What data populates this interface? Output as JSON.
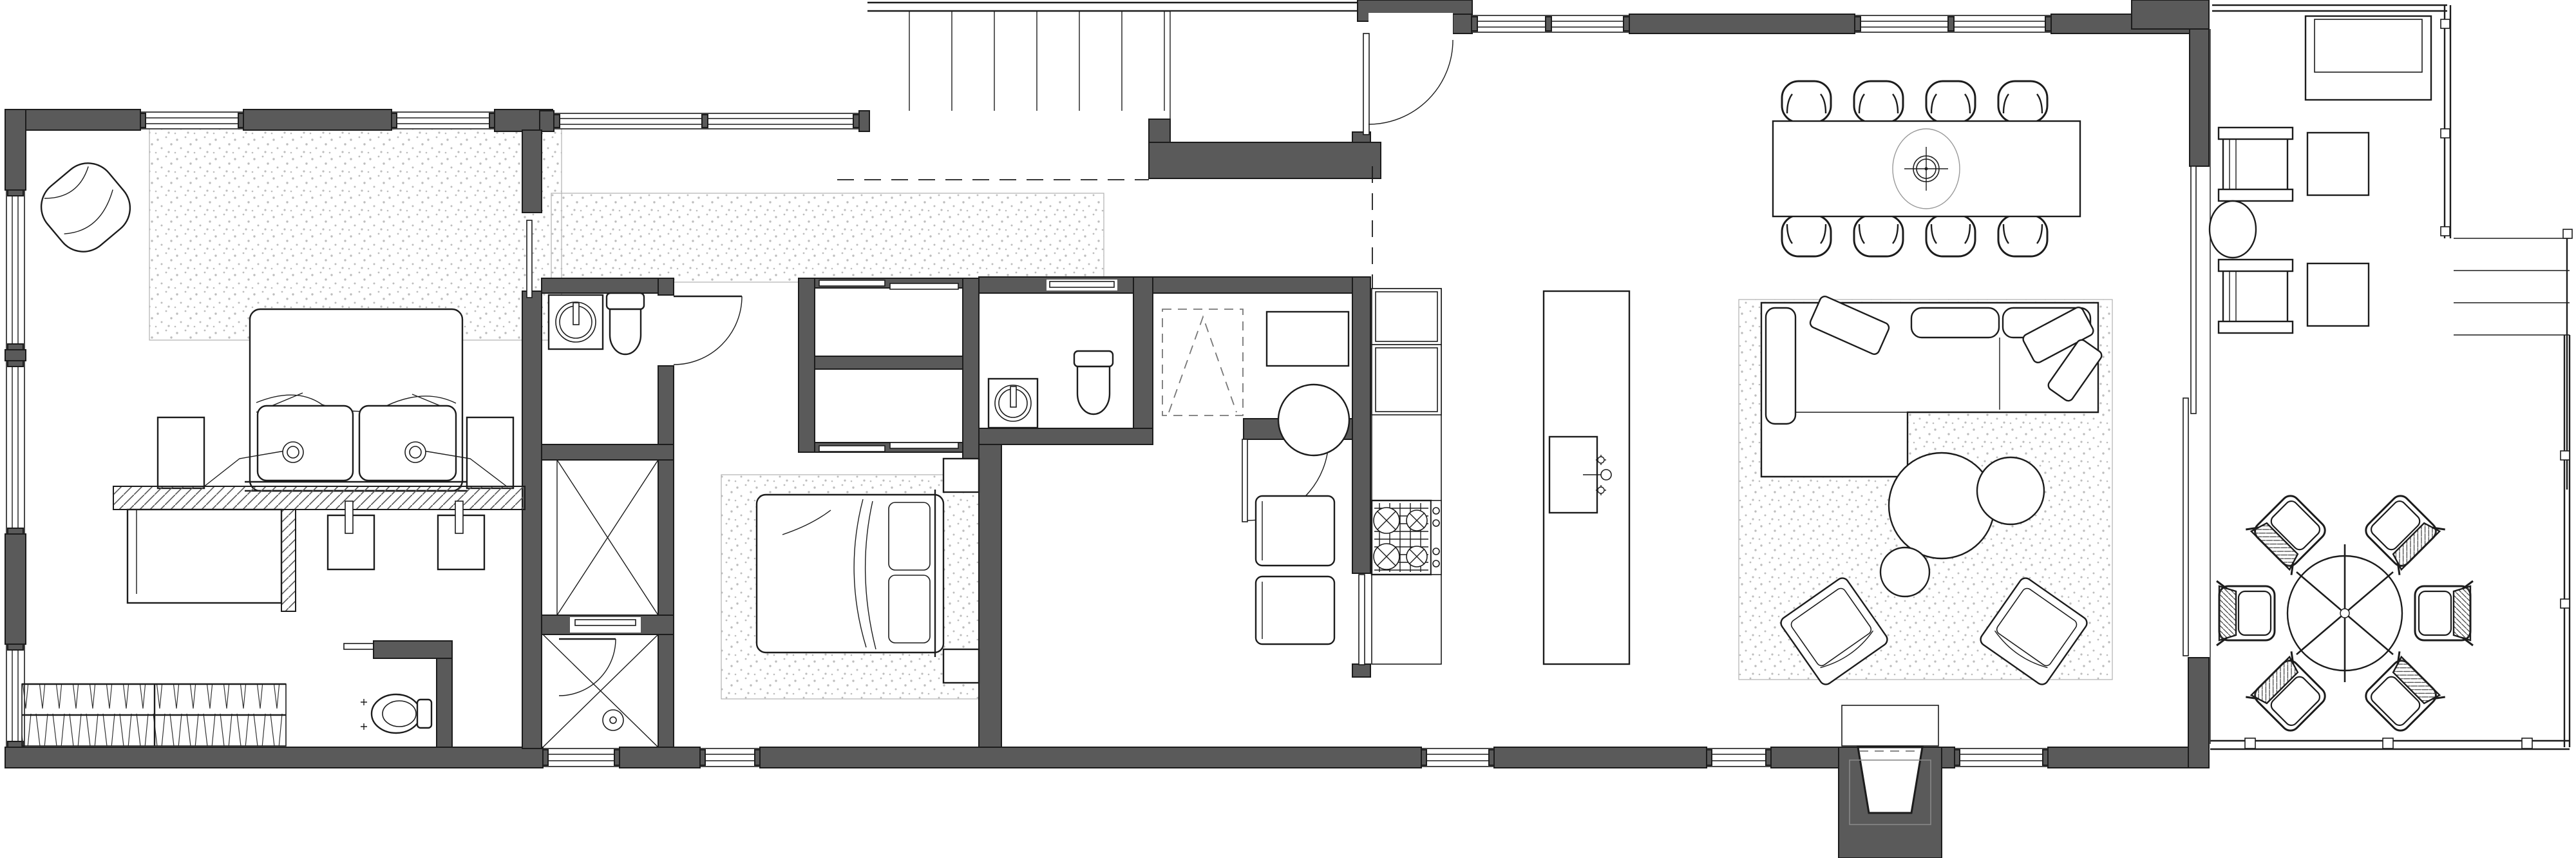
{
  "document": {
    "type": "architectural-floor-plan",
    "style": "black-and-white line drawing, top view",
    "visible_text": ""
  },
  "palette": {
    "wall": "#5a5a5a",
    "line": "#1c1c1c",
    "faint": "#999999",
    "stipple": "#bdbdbd",
    "paper": "#ffffff"
  },
  "rooms": {
    "master": {
      "label": "master bedroom",
      "furniture": [
        "double bed with duvet",
        "two pillows",
        "two swing-arm wall lamps",
        "two nightstands",
        "area rug",
        "lounge chair",
        "hatched vanity counter",
        "two square basins with faucets",
        "desk",
        "hanging wardrobe with clothes",
        "wc with toilet"
      ]
    },
    "bath1": {
      "label": "bathroom 1",
      "furniture": [
        "round countertop basin",
        "toilet",
        "hinged door"
      ]
    },
    "linen": {
      "label": "linen closet",
      "furniture": [
        "shelving unit (X symbol)"
      ]
    },
    "shower": {
      "label": "shower room",
      "furniture": [
        "shower tray (X symbol)",
        "floor drain",
        "glass door"
      ]
    },
    "bedroom2": {
      "label": "bedroom 2",
      "furniture": [
        "double bed",
        "two pillows",
        "two nightstands",
        "area rug",
        "double sliding-door closet"
      ]
    },
    "bath2": {
      "label": "bathroom 2",
      "furniture": [
        "round countertop basin",
        "toilet",
        "pocket door"
      ]
    },
    "flex": {
      "label": "flex / laundry room",
      "furniture": [
        "dashed attic-hatch symbol",
        "square table",
        "round stool",
        "two lounge chairs",
        "hinged door"
      ]
    },
    "hall": {
      "label": "entry hall",
      "furniture": [
        "runner rug",
        "front door with swing"
      ]
    },
    "kitchen": {
      "label": "kitchen",
      "furniture": [
        "wall cabinet run",
        "4-burner gas cooktop",
        "island with sink and faucet"
      ]
    },
    "dining": {
      "label": "dining area",
      "furniture": [
        "rectangular table",
        "eight chairs",
        "pendant light symbol"
      ]
    },
    "living": {
      "label": "living room",
      "furniture": [
        "L-shaped sectional sofa",
        "three round coffee tables",
        "two angled armchairs",
        "large area rug",
        "sliding glass wall"
      ]
    },
    "porchN": {
      "label": "recessed north entry porch",
      "furniture": [
        "exterior steps",
        "landing"
      ]
    },
    "porchS": {
      "label": "south entry porch",
      "furniture": [
        "splayed entry steps",
        "entry mat"
      ]
    },
    "deck": {
      "label": "east deck",
      "furniture": [
        "daybed",
        "two lounge chairs",
        "two square side tables",
        "oval side table",
        "round dining table with umbrella",
        "six outdoor chairs",
        "railing",
        "two exterior stairs"
      ]
    }
  },
  "counts": {
    "windows": 13,
    "door_swings": 6,
    "sliding_doors": 6,
    "dining_chairs": 8,
    "outdoor_chairs": 6
  }
}
